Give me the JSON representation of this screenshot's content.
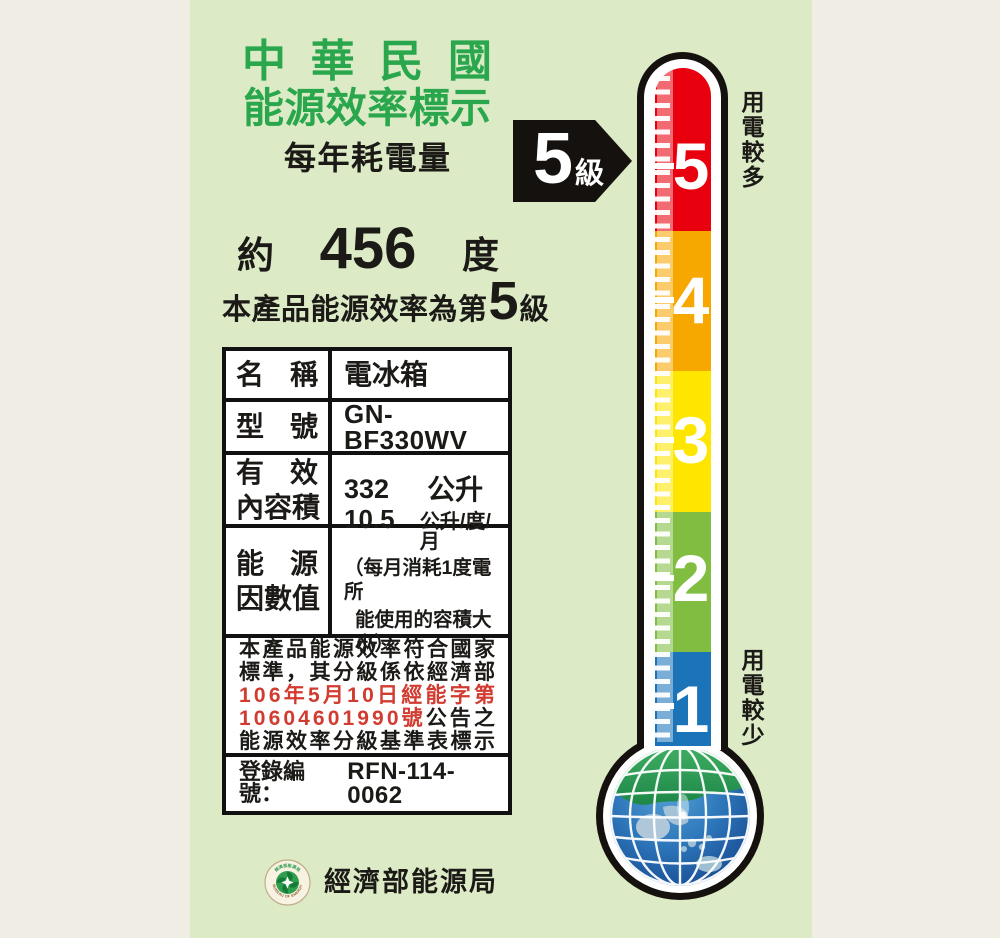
{
  "colors": {
    "panel_bg": "#dcebc6",
    "margin_bg": "#f0ede5",
    "title_green": "#2aa64d",
    "notice_red": "#d23b2f",
    "grade5_red": "#e8000f",
    "grade4_orange": "#f6a800",
    "grade3_yellow": "#ffe600",
    "grade2_green": "#80bd41",
    "grade1_blue": "#1b74b8"
  },
  "header": {
    "title_line1": "中華民國",
    "title_line2": "能源效率標示",
    "subtitle": "每年耗電量"
  },
  "consumption": {
    "prefix": "約",
    "value": "456",
    "unit": "度"
  },
  "grade_statement": {
    "before": "本產品能源效率為第",
    "grade": "5",
    "after": "級"
  },
  "grade_arrow": {
    "grade": "5",
    "unit": "級"
  },
  "spec_table": {
    "rows": {
      "name": {
        "label": "名稱",
        "value": "電冰箱"
      },
      "model": {
        "label": "型號",
        "value": "GN-BF330WV"
      },
      "volume": {
        "label_line1": "有效",
        "label_line2": "內容積",
        "value": "332",
        "unit": "公升"
      },
      "factor": {
        "label_line1": "能源",
        "label_line2": "因數值",
        "value": "10.5",
        "unit": "公升/度/月",
        "note_line1": "（每月消耗1度電所",
        "note_line2": "能使用的容積大小）"
      }
    },
    "notice_segments": [
      [
        {
          "t": "本產品能源效率符合國家",
          "c": "k"
        }
      ],
      [
        {
          "t": "標準，其分級係依經濟部",
          "c": "k"
        }
      ],
      [
        {
          "t": "106年5月10日經能字第",
          "c": "r"
        }
      ],
      [
        {
          "t": "10604601990號",
          "c": "r"
        },
        {
          "t": "公告之",
          "c": "k"
        }
      ],
      [
        {
          "t": "能源效率分級基準表標示",
          "c": "k"
        }
      ]
    ],
    "registration": {
      "label": "登錄編號：",
      "value": "RFN-114-0062"
    }
  },
  "bureau": {
    "agency": "經濟部能源局",
    "logo_arc_top": "經濟部能源局",
    "logo_arc_bottom": "BUREAU OF ENERGY"
  },
  "thermometer": {
    "sections": [
      {
        "grade": "5",
        "color": "#e8000f"
      },
      {
        "grade": "4",
        "color": "#f6a800"
      },
      {
        "grade": "3",
        "color": "#ffe600"
      },
      {
        "grade": "2",
        "color": "#80bd41"
      },
      {
        "grade": "1",
        "color": "#1b74b8"
      }
    ],
    "label_top": "用電較多",
    "label_bottom": "用電較少"
  }
}
